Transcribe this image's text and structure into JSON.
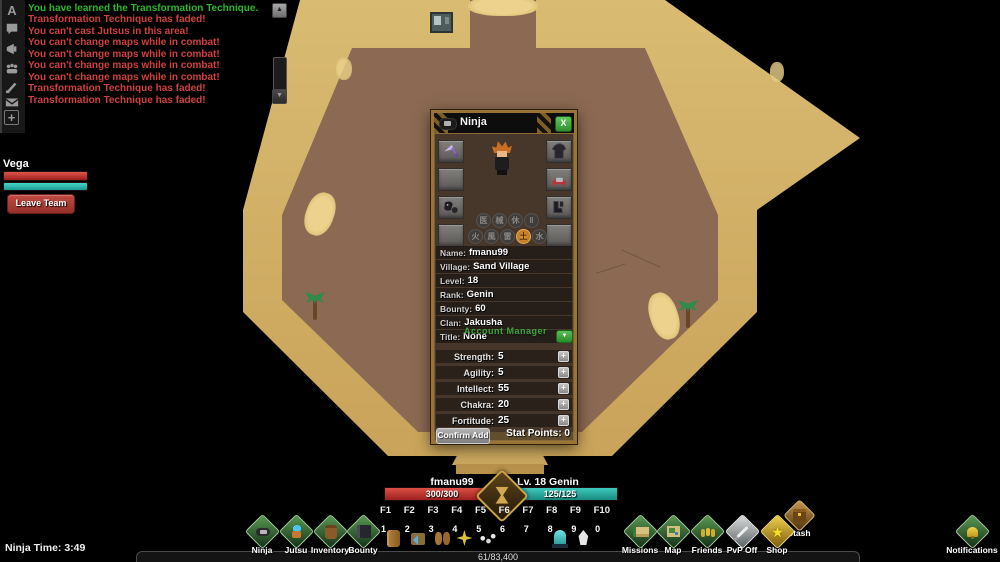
{
  "chat": {
    "icon_a": "A",
    "messages": [
      {
        "text": "You have learned the Transformation Technique.",
        "color": "green"
      },
      {
        "text": "Transformation Technique has faded!",
        "color": "red"
      },
      {
        "text": "You can't cast Jutsus in this area!",
        "color": "red"
      },
      {
        "text": "You can't change maps while in combat!",
        "color": "red"
      },
      {
        "text": "You can't change maps while in combat!",
        "color": "red"
      },
      {
        "text": "You can't change maps while in combat!",
        "color": "red"
      },
      {
        "text": "You can't change maps while in combat!",
        "color": "red"
      },
      {
        "text": "Transformation Technique has faded!",
        "color": "red"
      },
      {
        "text": "Transformation Technique has faded!",
        "color": "red"
      }
    ],
    "scroll_up": "▲",
    "scroll_down": "▼",
    "add_tab": "+"
  },
  "team": {
    "name": "Vega",
    "leave_label": "Leave Team"
  },
  "ninja_window": {
    "title": "Ninja",
    "close_label": "X",
    "npc_behind": "Account Manager",
    "elements_row1": [
      "医",
      "械",
      "休",
      "‖"
    ],
    "elements_row2": [
      "火",
      "風",
      "雷",
      "土",
      "水"
    ],
    "active_element": "土",
    "info": [
      {
        "label": "Name:",
        "value": "fmanu99"
      },
      {
        "label": "Village:",
        "value": "Sand Village"
      },
      {
        "label": "Level:",
        "value": "18"
      },
      {
        "label": "Rank:",
        "value": "Genin"
      },
      {
        "label": "Bounty:",
        "value": "60"
      },
      {
        "label": "Clan:",
        "value": "Jakusha"
      },
      {
        "label": "Title:",
        "value": "None"
      }
    ],
    "title_dropdown": "▼",
    "stats": [
      {
        "label": "Strength:",
        "value": "5"
      },
      {
        "label": "Agility:",
        "value": "5"
      },
      {
        "label": "Intellect:",
        "value": "55"
      },
      {
        "label": "Chakra:",
        "value": "20"
      },
      {
        "label": "Fortitude:",
        "value": "25"
      }
    ],
    "plus": "+",
    "confirm_label": "Confirm Add",
    "stat_points": "Stat Points: 0"
  },
  "hud": {
    "player_name": "fmanu99",
    "player_level": "Lv. 18 Genin",
    "hp": "300/300",
    "chakra": "125/125",
    "fkeys": [
      "F1",
      "F2",
      "F3",
      "F4",
      "F5",
      "F6",
      "F7",
      "F8",
      "F9",
      "F10"
    ],
    "slots": [
      {
        "key": "1",
        "item": "log"
      },
      {
        "key": "2",
        "item": "trap"
      },
      {
        "key": "3",
        "item": "pouches"
      },
      {
        "key": "4",
        "item": "shuriken"
      },
      {
        "key": "5",
        "item": "senbon"
      },
      {
        "key": "6",
        "item": ""
      },
      {
        "key": "7",
        "item": ""
      },
      {
        "key": "8",
        "item": "ghost-charm"
      },
      {
        "key": "9",
        "item": "feather-brush"
      },
      {
        "key": "0",
        "item": ""
      }
    ],
    "xp": "61/83,400",
    "ninja_time": "Ninja Time: 3:49"
  },
  "menu": {
    "left": [
      {
        "label": "Ninja"
      },
      {
        "label": "Jutsu"
      },
      {
        "label": "Inventory"
      },
      {
        "label": "Bounty"
      }
    ],
    "right": [
      {
        "label": "Missions"
      },
      {
        "label": "Map"
      },
      {
        "label": "Friends"
      },
      {
        "label": "PvP Off"
      },
      {
        "label": "Shop"
      },
      {
        "label": "Stash"
      },
      {
        "label": "Notifications"
      }
    ]
  },
  "colors": {
    "hp": "#c23636",
    "chakra": "#2ab5ab",
    "chat_green": "#28b828",
    "chat_red": "#d04040",
    "wall": "#d0ae64",
    "floor": "#8b6952",
    "accent_green": "#3fae3f",
    "frame_gold": "#9a7336"
  }
}
